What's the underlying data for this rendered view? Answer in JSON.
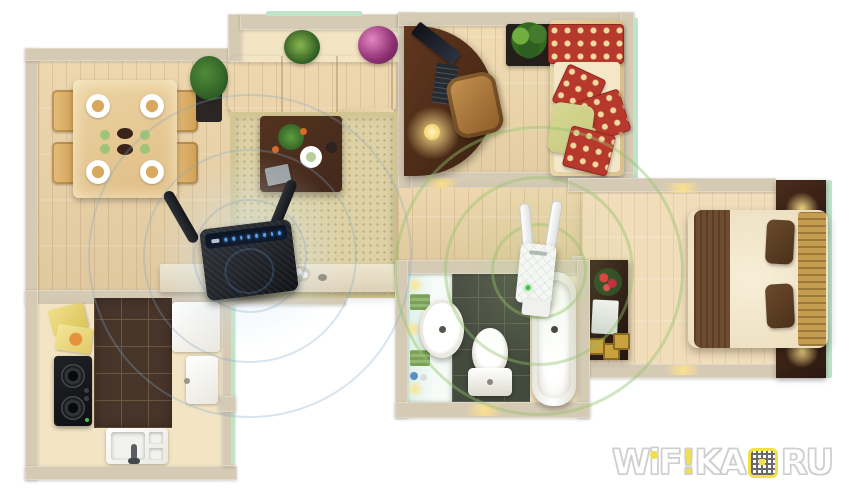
{
  "scene": {
    "subject": "apartment floor plan with wifi router and range extender coverage"
  },
  "rooms": [
    {
      "name": "dining-area"
    },
    {
      "name": "living-room"
    },
    {
      "name": "study-room"
    },
    {
      "name": "bedroom"
    },
    {
      "name": "hallway"
    },
    {
      "name": "bathroom"
    },
    {
      "name": "kitchen"
    }
  ],
  "devices": {
    "router": {
      "label": "wireless-router",
      "antenna_count": 2,
      "led_count": 8
    },
    "extender": {
      "label": "wifi-range-extender",
      "antenna_count": 2,
      "led_count": 1
    }
  },
  "watermark": {
    "full": "WiFiKA.RU",
    "letters": {
      "w": "W",
      "i": "i",
      "f": "F",
      "bang": "!",
      "ka": "KA",
      "ru": "RU"
    }
  },
  "colors": {
    "wall": "#d5cab4",
    "wall_edge": "#bdb098",
    "wall_light": "#e8dfca",
    "mint": "#c0e4ca",
    "floor_a": "#ecd3a6",
    "floor_b": "#e2c291",
    "floor_bed": "#f1ddba",
    "cream": "#f3e5c3",
    "rug": "#ddd1a5",
    "sofa": "#ebd8b1",
    "wood_dark": "#42281b",
    "red": "#b7382c",
    "polka_dot": "#eeda9f",
    "green_pillow": "#c6c97e",
    "tile_bath": "#3d3c37",
    "tile_bath_line": "#5a574d",
    "tile_kitchen": "#48352a",
    "tile_kitchen_line": "#6e573f",
    "router_dark": "#23262c",
    "led_blue": "#57a0f0",
    "ext_white": "#f5f7f4",
    "led_green": "#42c24c",
    "glow": "#ffd878",
    "wifi_blue": "rgba(125,165,200,0.30)",
    "wifi_green": "rgba(145,195,105,0.42)",
    "wm_yellow": "#f1e04b",
    "wm_outline": "#cfcfcf",
    "aqua": "#ddf1e8"
  }
}
